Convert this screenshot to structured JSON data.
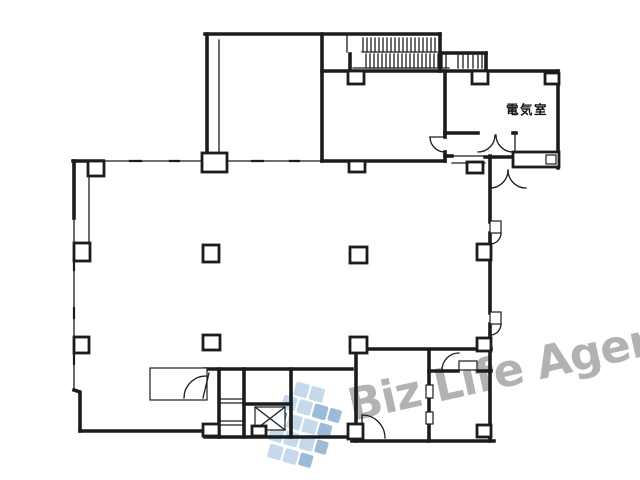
{
  "page": {
    "type": "scanned floor plan drawing",
    "background": "#ffffff",
    "line_color": "#1c1c1c"
  },
  "plan": {
    "labels": {
      "electrical_room": "電気室"
    },
    "features": {
      "stairs": "hatched stair treads top area",
      "elevator": "crossed-box shaft bottom center"
    }
  },
  "watermark": {
    "text": "Biz Life Agent",
    "color": "#b2b2b2"
  },
  "logo": {
    "light": "#c6d9eb",
    "mid": "#9bbbd8",
    "dark": "#7097bd"
  }
}
